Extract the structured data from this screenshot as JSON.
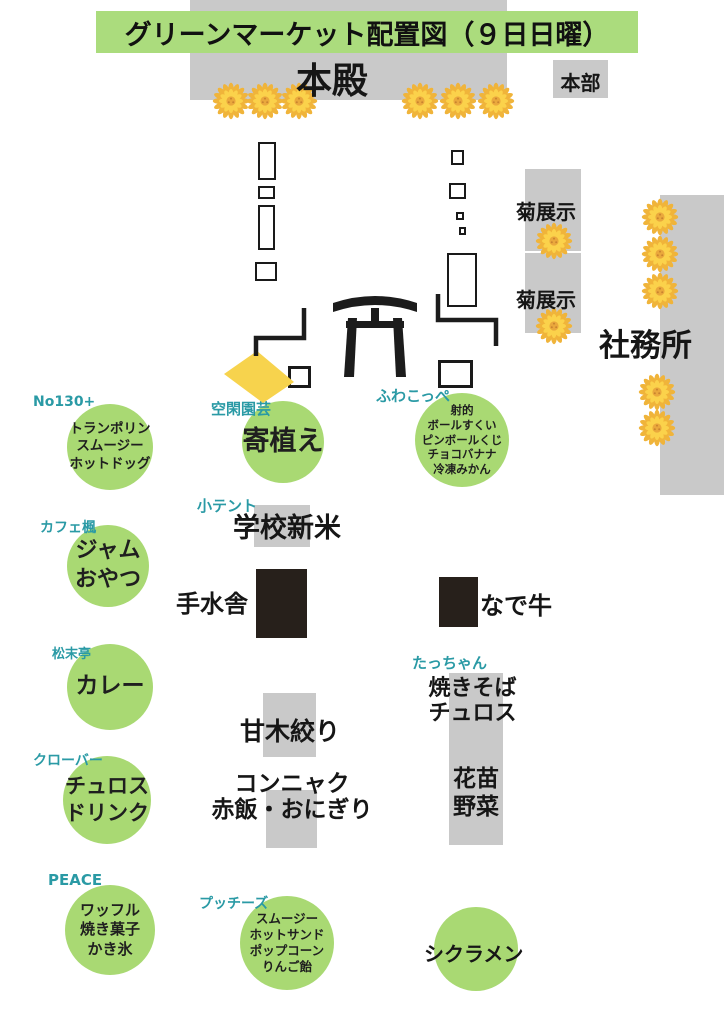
{
  "title": "グリーンマーケット配置図（９日日曜）",
  "colors": {
    "title_green": "#abdc7d",
    "circle_green": "#a9d973",
    "vendor_teal": "#2a9aa5",
    "area_gray": "#c9c9c9",
    "structure_black": "#27201b",
    "flag_yellow": "#f7d34d",
    "flower_yellow": "#f2b93d"
  },
  "map": {
    "honden": "本殿",
    "honbu": "本部",
    "kiku_exhibit_1": "菊展示",
    "kiku_exhibit_2": "菊展示",
    "shamusho": "社務所",
    "temizusha": "手水舎",
    "nadeushi": "なで牛",
    "amagi_shibori": "甘木絞り",
    "konnyaku": [
      "コンニャク",
      "赤飯・おにぎり"
    ],
    "hananae": [
      "花苗",
      "野菜"
    ],
    "cyclamen": "シクラメン"
  },
  "stalls": [
    {
      "vendor": "No130+",
      "items": [
        "トランポリン",
        "スムージー",
        "ホットドッグ"
      ]
    },
    {
      "vendor": "空閑園芸",
      "items": [
        "寄植え"
      ]
    },
    {
      "vendor": "ふわこっぺ",
      "items": [
        "射的",
        "ボールすくい",
        "ピンボールくじ",
        "チョコバナナ",
        "冷凍みかん"
      ]
    },
    {
      "vendor": "カフェ楓",
      "items": [
        "ジャム",
        "おやつ"
      ]
    },
    {
      "vendor": "小テント",
      "items": [
        "学校新米"
      ]
    },
    {
      "vendor": "松末亭",
      "items": [
        "カレー"
      ]
    },
    {
      "vendor": "たっちゃん",
      "items": [
        "焼きそば",
        "チュロス"
      ]
    },
    {
      "vendor": "クローバー",
      "items": [
        "チュロス",
        "ドリンク"
      ]
    },
    {
      "vendor": "PEACE",
      "items": [
        "ワッフル",
        "焼き菓子",
        "かき氷"
      ]
    },
    {
      "vendor": "プッチーズ",
      "items": [
        "スムージー",
        "ホットサンド",
        "ポップコーン",
        "りんご飴"
      ]
    }
  ]
}
